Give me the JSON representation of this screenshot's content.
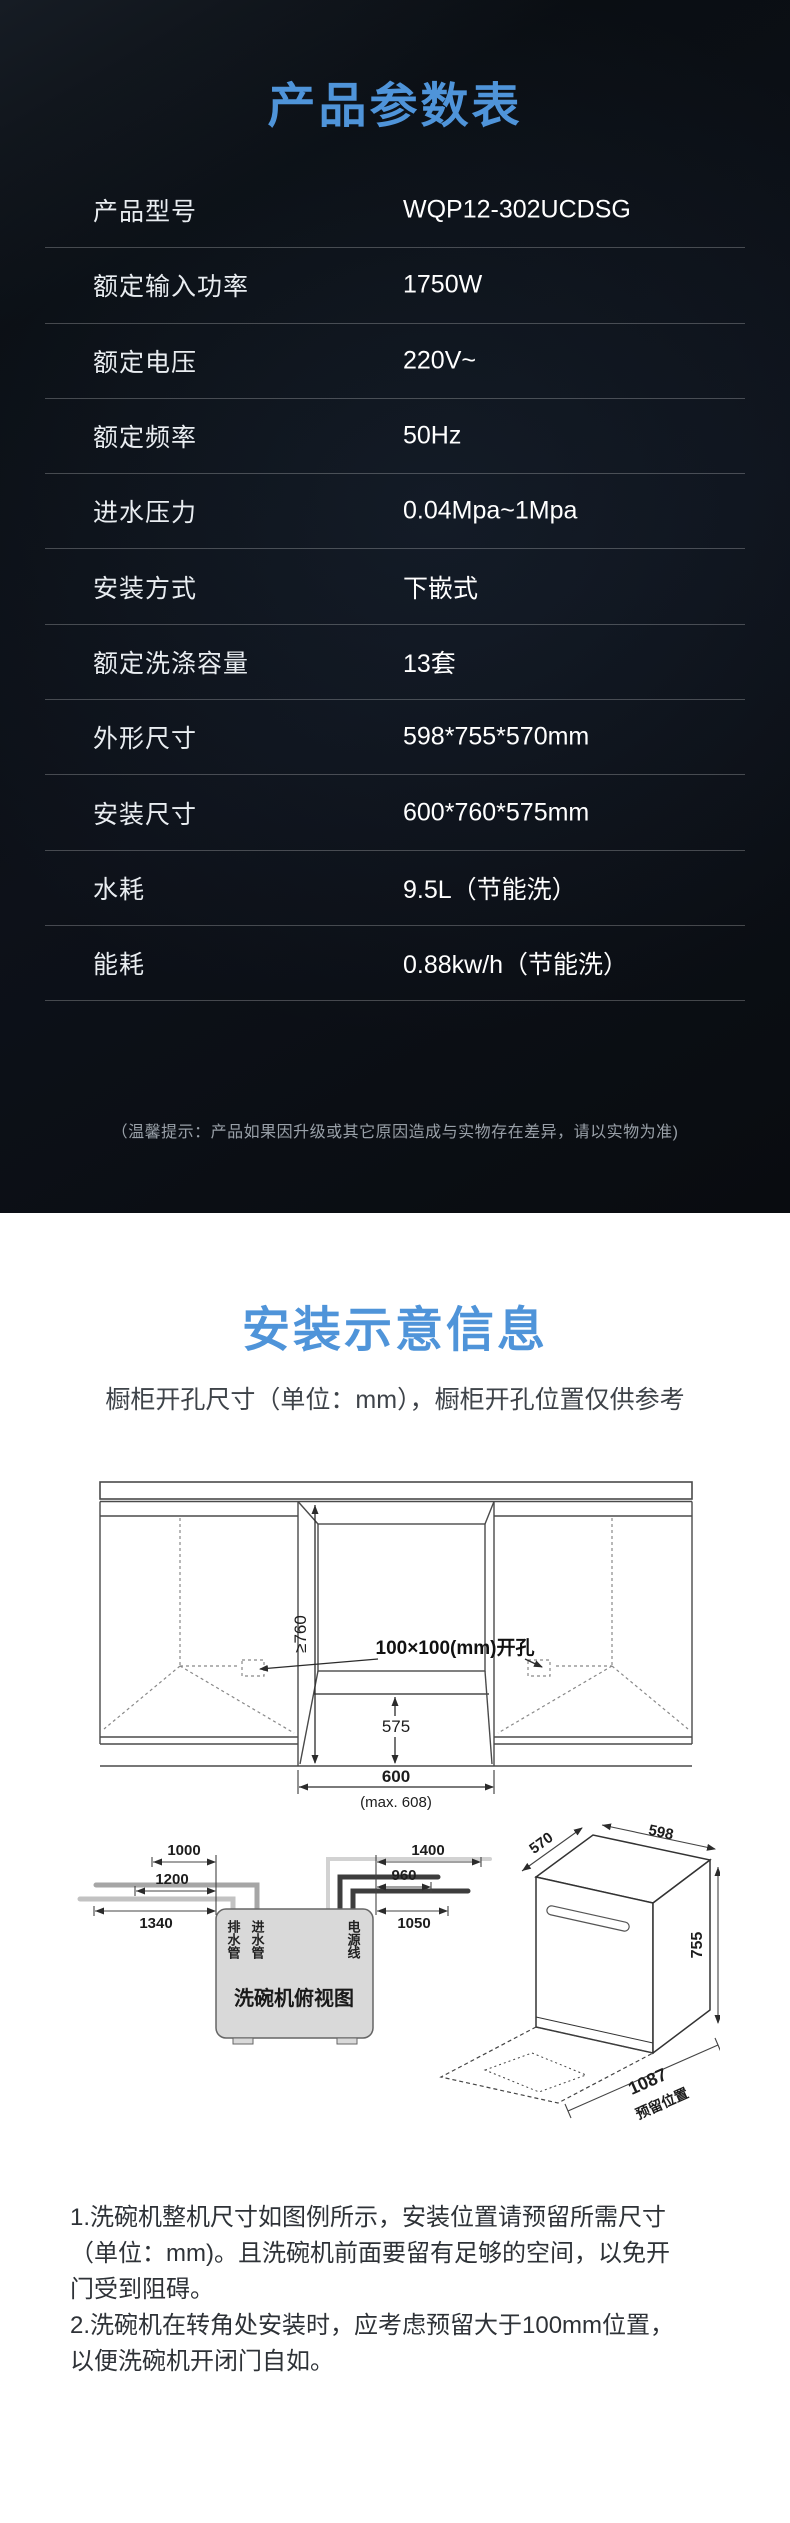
{
  "spec_section": {
    "title": "产品参数表",
    "rows": [
      {
        "label": "产品型号",
        "value": "WQP12-302UCDSG"
      },
      {
        "label": "额定输入功率",
        "value": "1750W"
      },
      {
        "label": "额定电压",
        "value": "220V~"
      },
      {
        "label": "额定频率",
        "value": "50Hz"
      },
      {
        "label": "进水压力",
        "value": "0.04Mpa~1Mpa"
      },
      {
        "label": "安装方式",
        "value": "下嵌式"
      },
      {
        "label": "额定洗涤容量",
        "value": "13套"
      },
      {
        "label": "外形尺寸",
        "value": "598*755*570mm"
      },
      {
        "label": "安装尺寸",
        "value": "600*760*575mm"
      },
      {
        "label": "水耗",
        "value": "9.5L（节能洗）"
      },
      {
        "label": "能耗",
        "value": "0.88kw/h（节能洗）"
      }
    ],
    "note": "（温馨提示：产品如果因升级或其它原因造成与实物存在差异，请以实物为准)"
  },
  "install_section": {
    "title": "安装示意信息",
    "subtitle": "橱柜开孔尺寸（单位：mm），橱柜开孔位置仅供参考",
    "cabinet_diagram": {
      "height_dim": "≥760",
      "cutout_label": "100×100(mm)开孔",
      "depth_dim": "575",
      "width_dim": "600",
      "width_max": "(max. 608)"
    },
    "top_view": {
      "label": "洗碗机俯视图",
      "drain_hose": "排水管",
      "inlet_hose": "进水管",
      "power_cord": "电源线",
      "left_dims": [
        "1000",
        "1200",
        "1340"
      ],
      "right_dims": [
        "1400",
        "960",
        "1050"
      ]
    },
    "machine_view": {
      "depth_dim": "570",
      "width_dim": "598",
      "height_dim": "755",
      "reserve_dim": "1087",
      "reserve_label": "预留位置"
    },
    "notes": [
      "1.洗碗机整机尺寸如图例所示，安装位置请预留所需尺寸",
      "（单位：mm)。且洗碗机前面要留有足够的空间，以免开",
      "门受到阻碍。",
      "2.洗碗机在转角处安装时，应考虑预留大于100mm位置，",
      "以便洗碗机开闭门自如。"
    ]
  },
  "colors": {
    "accent_blue": "#4f94d9",
    "panel_bg": "#0c1016"
  }
}
